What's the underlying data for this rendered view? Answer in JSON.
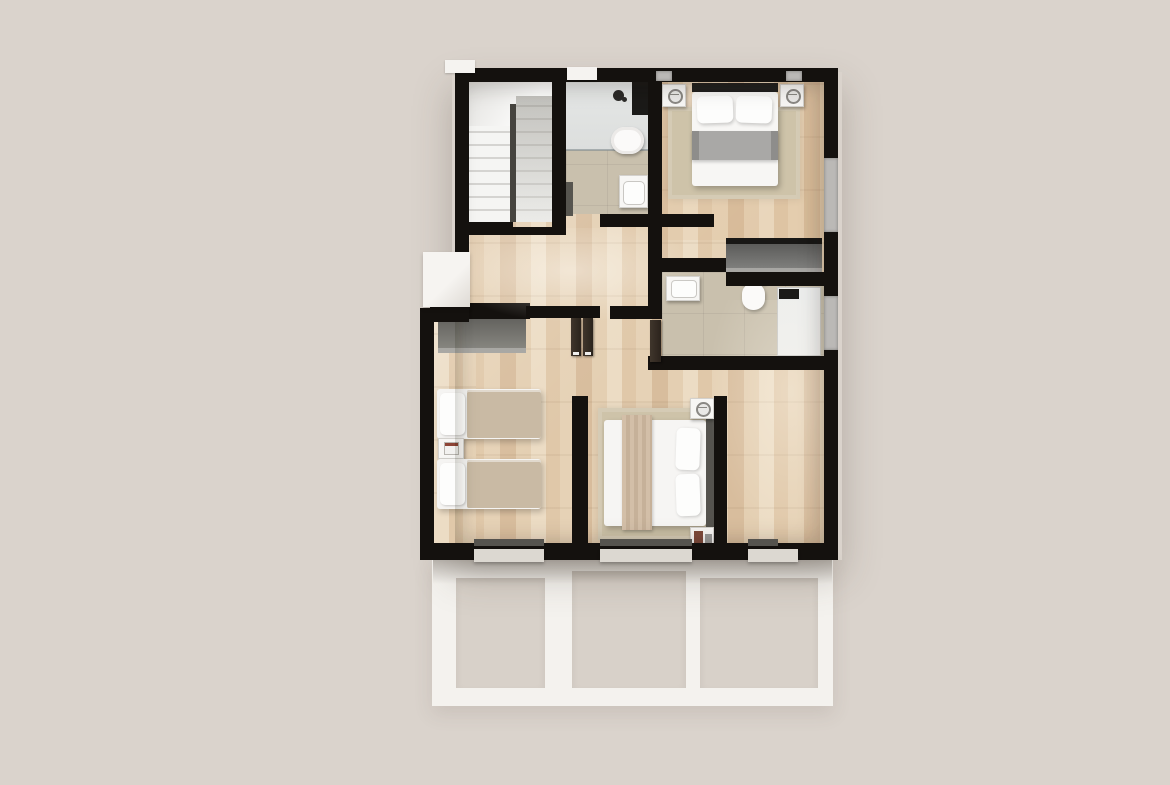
{
  "scene": {
    "description": "3D rendered top-down architectural floor plan of an apartment upper floor with two bathrooms, three bedrooms, a staircase, hallway and terrace structure below",
    "view": "top-down",
    "style": "photorealistic-3d-render",
    "text_labels_visible": "none"
  },
  "palette": {
    "background": "#dad3cc",
    "walls": "#14110e",
    "wood_floor_light": "#ecdcc4",
    "wood_floor_dark": "#d8bd9d",
    "bathroom_tile": "#c9c0ad",
    "shower_zone": "#e1e3e2",
    "stair_floor": "#edecea",
    "white_fixtures": "#f7f6f4",
    "terrace_frame": "#f4f2ee",
    "terrace_opening": "#d8d1c9",
    "rug_beige": "#cec3a9",
    "blanket_gray": "#a7a6a4",
    "throw_beige": "#ccb8a1",
    "wardrobe_gray": "#75746f",
    "door_wood": "#362d25",
    "twin_bed_cover": "#c9baa4"
  },
  "rooms": [
    {
      "id": "staircase",
      "features": [
        "u-shaped-staircase",
        "center-handrail",
        "landing"
      ]
    },
    {
      "id": "bathroom-1",
      "features": [
        "walk-in-shower",
        "shower-column",
        "shower-head",
        "toilet",
        "washbasin",
        "towel-radiator",
        "tiled-floor"
      ]
    },
    {
      "id": "master-bedroom",
      "features": [
        "double-bed",
        "gray-blanket",
        "two-pillows",
        "nightstand-left",
        "nightstand-right",
        "table-lamps",
        "area-rug",
        "wardrobe"
      ]
    },
    {
      "id": "hallway",
      "features": [
        "open-double-doors",
        "wood-flooring"
      ]
    },
    {
      "id": "bathroom-2",
      "features": [
        "washbasin",
        "toilet",
        "walk-in-shower",
        "shower-head",
        "entry-door",
        "tiled-floor"
      ]
    },
    {
      "id": "twin-bedroom",
      "features": [
        "wardrobe",
        "single-bed-1",
        "single-bed-2",
        "nightstand",
        "books"
      ]
    },
    {
      "id": "bedroom-3",
      "features": [
        "double-bed",
        "beige-throw-blanket",
        "pillows",
        "nightstand-top",
        "nightstand-bottom",
        "table-lamps",
        "area-rug",
        "picture-frames"
      ]
    },
    {
      "id": "terrace-structure",
      "features": [
        "white-pergola-frame",
        "three-openings"
      ]
    }
  ],
  "exterior": {
    "windows": [
      "top-wall-vent-left",
      "top-wall-vent-center",
      "master-top-window-left",
      "master-top-window-right",
      "right-wall-window-upper",
      "right-wall-window-lower",
      "bottom-window-left",
      "bottom-window-center",
      "bottom-window-right"
    ],
    "white_ledge": "left-side-light-well"
  }
}
